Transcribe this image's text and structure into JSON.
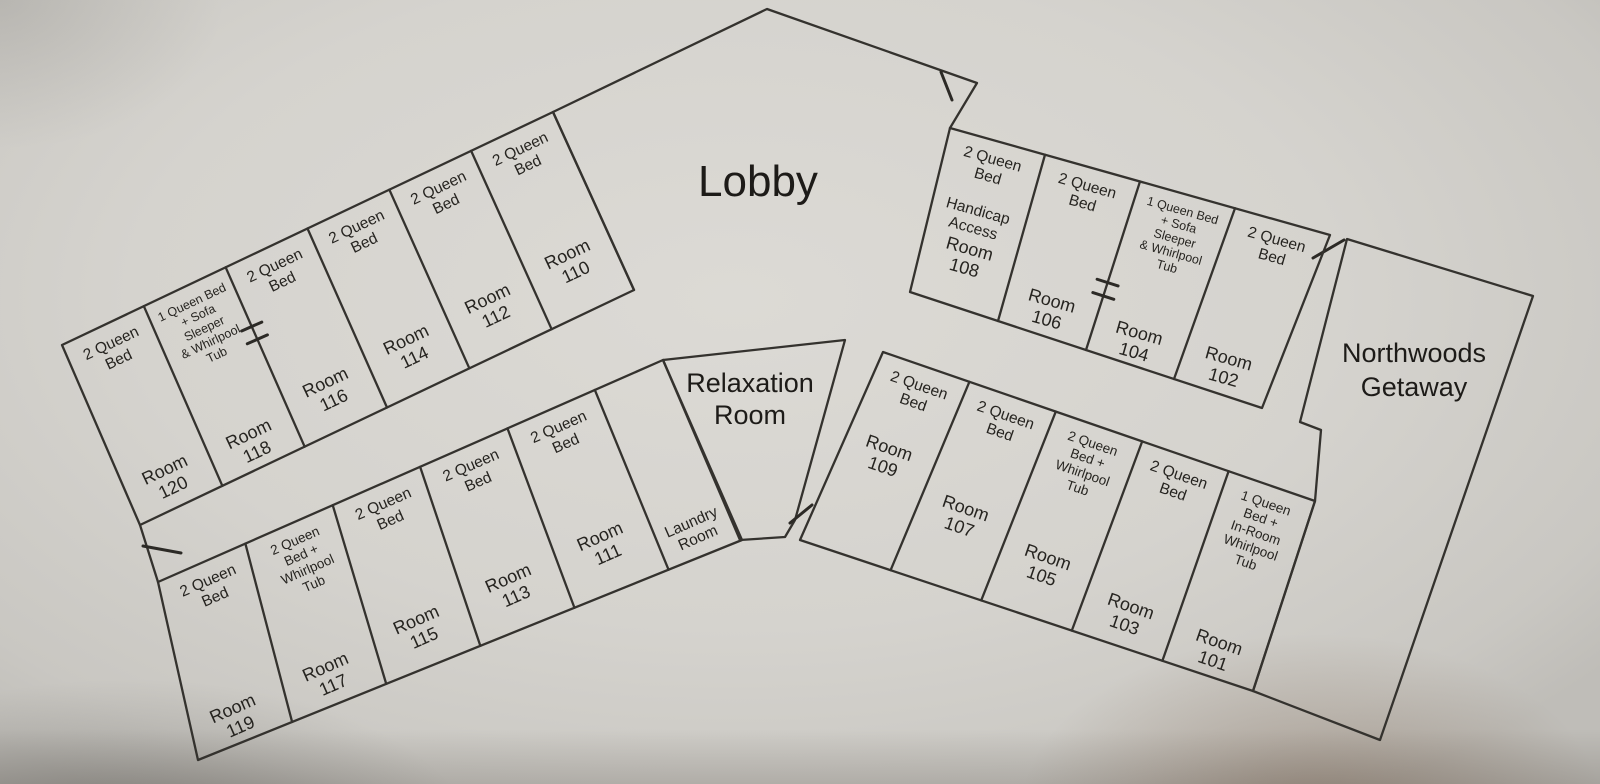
{
  "areas": {
    "lobby": {
      "label": "Lobby"
    },
    "relaxation": {
      "label_lines": [
        "Relaxation",
        "Room"
      ]
    },
    "getaway": {
      "label_lines": [
        "Northwoods",
        "Getaway"
      ]
    }
  },
  "wings": [
    {
      "id": "northwest",
      "rooms": [
        {
          "type_lines": [
            "2 Queen",
            "Bed"
          ],
          "number_lines": [
            "Room",
            "120"
          ]
        },
        {
          "type_lines": [
            "1 Queen Bed",
            "+ Sofa",
            "Sleeper",
            "& Whirlpool",
            "Tub"
          ],
          "number_lines": [
            "Room",
            "118"
          ]
        },
        {
          "type_lines": [
            "2 Queen",
            "Bed"
          ],
          "number_lines": [
            "Room",
            "116"
          ]
        },
        {
          "type_lines": [
            "2 Queen",
            "Bed"
          ],
          "number_lines": [
            "Room",
            "114"
          ]
        },
        {
          "type_lines": [
            "2 Queen",
            "Bed"
          ],
          "number_lines": [
            "Room",
            "112"
          ]
        },
        {
          "type_lines": [
            "2 Queen",
            "Bed"
          ],
          "number_lines": [
            "Room",
            "110"
          ]
        }
      ]
    },
    {
      "id": "southwest",
      "rooms": [
        {
          "type_lines": [
            "2 Queen",
            "Bed"
          ],
          "number_lines": [
            "Room",
            "119"
          ]
        },
        {
          "type_lines": [
            "2 Queen",
            "Bed +",
            "Whirlpool",
            "Tub"
          ],
          "number_lines": [
            "Room",
            "117"
          ]
        },
        {
          "type_lines": [
            "2 Queen",
            "Bed"
          ],
          "number_lines": [
            "Room",
            "115"
          ]
        },
        {
          "type_lines": [
            "2 Queen",
            "Bed"
          ],
          "number_lines": [
            "Room",
            "113"
          ]
        },
        {
          "type_lines": [
            "2 Queen",
            "Bed"
          ],
          "number_lines": [
            "Room",
            "111"
          ]
        },
        {
          "type_lines": [],
          "number_lines": [
            "Laundry",
            "Room"
          ]
        }
      ]
    },
    {
      "id": "northeast",
      "rooms": [
        {
          "type_lines": [
            "2 Queen",
            "Bed",
            "",
            "Handicap",
            "Access"
          ],
          "number_lines": [
            "Room",
            "108"
          ]
        },
        {
          "type_lines": [
            "2 Queen",
            "Bed"
          ],
          "number_lines": [
            "Room",
            "106"
          ]
        },
        {
          "type_lines": [
            "1 Queen Bed",
            "+ Sofa",
            "Sleeper",
            "& Whirlpool",
            "Tub"
          ],
          "number_lines": [
            "Room",
            "104"
          ]
        },
        {
          "type_lines": [
            "2 Queen",
            "Bed"
          ],
          "number_lines": [
            "Room",
            "102"
          ]
        }
      ]
    },
    {
      "id": "southeast",
      "rooms": [
        {
          "type_lines": [
            "2 Queen",
            "Bed"
          ],
          "number_lines": [
            "Room",
            "109"
          ]
        },
        {
          "type_lines": [
            "2 Queen",
            "Bed"
          ],
          "number_lines": [
            "Room",
            "107"
          ]
        },
        {
          "type_lines": [
            "2 Queen",
            "Bed +",
            "Whirlpool",
            "Tub"
          ],
          "number_lines": [
            "Room",
            "105"
          ]
        },
        {
          "type_lines": [
            "2 Queen",
            "Bed"
          ],
          "number_lines": [
            "Room",
            "103"
          ]
        },
        {
          "type_lines": [
            "1 Queen",
            "Bed +",
            "In-Room",
            "Whirlpool",
            "Tub"
          ],
          "number_lines": [
            "Room",
            "101"
          ]
        }
      ]
    }
  ],
  "colors": {
    "paper": "#d5d3ce",
    "ink": "#34322e"
  }
}
